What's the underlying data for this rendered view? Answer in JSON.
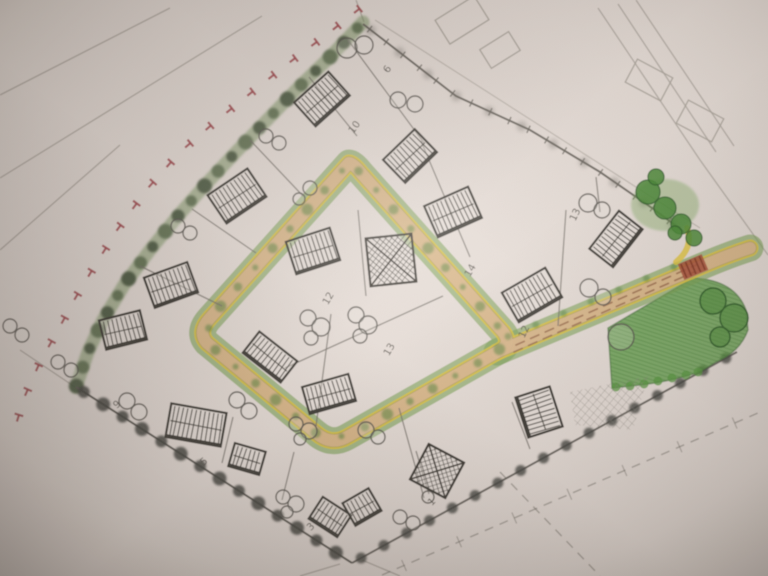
{
  "meta": {
    "type": "hand-drawn residential site plan sketch",
    "medium": "pencil and colored pencil on photographed paper",
    "description": "Diamond-shaped development site with a looped access road, hatched house footprints, tree symbols, hedgerows, a green open space with paved red crossing, and red T boundary markings."
  },
  "colors": {
    "paper": "#e7ded8",
    "pencil_dark": "#3d3a34",
    "pencil_mid": "#6f6b63",
    "pencil_faint": "#aba49b",
    "road_surface": "#dcb88d",
    "road_edge_yellow": "#e2c63e",
    "road_pencil_edge": "#8d867b",
    "verge_green": "#7ba155",
    "verge_blob_green": "#4e8038",
    "hedge_green": "#75905c",
    "hedge_dark": "#3e4c36",
    "open_space_green": "#55973d",
    "open_space_stroke": "#2f6b24",
    "tree_green_fill": "#4c8a38",
    "tree_green_stroke": "#30612a",
    "tree_outline": "#5b5852",
    "boundary_red": "#a34a50",
    "crossing_red": "#a8503a",
    "crossing_dark": "#7c3524",
    "centerline_brown": "#96684a",
    "number_ink": "#55514a"
  },
  "plan": {
    "loop_road_path": "M349,163 L210,318 Q197,332 207,343 L316,433 Q331,446 347,437 L499,351 Q512,344 503,332 L361,173 Q353,163 349,163 Z",
    "exit_road_path": "M497,352 L700,267 Q728,255 750,248",
    "exit_centerlines": [
      [
        516,
        345,
        696,
        265
      ],
      [
        514,
        352,
        694,
        272
      ]
    ],
    "exit_corner_curl": "M676,262 Q694,247 687,228",
    "crossing": {
      "x": 693,
      "y": 267,
      "w": 26,
      "h": 17,
      "r": -23
    },
    "hedge_points": [
      363,
      22,
      330,
      57,
      300,
      86,
      268,
      119,
      237,
      151,
      207,
      183,
      178,
      216,
      150,
      250,
      124,
      285,
      103,
      320,
      88,
      352,
      76,
      387
    ],
    "red_t_points": [
      368,
      2,
      330,
      32,
      290,
      62,
      252,
      92,
      215,
      122,
      180,
      152,
      148,
      188,
      120,
      226,
      97,
      262,
      76,
      297,
      58,
      330,
      40,
      362,
      24,
      398,
      12,
      438
    ],
    "sw_boundary": [
      76,
      387,
      352,
      563
    ],
    "se_boundary": [
      352,
      563,
      640,
      405,
      737,
      352
    ],
    "ne_boundary": [
      363,
      24,
      456,
      96,
      530,
      130,
      600,
      172,
      652,
      208,
      684,
      232
    ],
    "ne_parallel": [
      375,
      20,
      700,
      228
    ],
    "green_space_path": "M608,328 L693,278 Q735,280 746,310 L748,330 Q740,352 716,362 L700,372 Q668,382 640,385 L612,388 Z",
    "green_scallops": [
      [
        616,
        387
      ],
      [
        630,
        386
      ],
      [
        644,
        384
      ],
      [
        658,
        381
      ],
      [
        672,
        378
      ],
      [
        686,
        375
      ],
      [
        698,
        372
      ]
    ],
    "crosshatch_path": "M570,392 L648,376 L633,430 L575,425 Z",
    "buildings": [
      {
        "x": 322,
        "y": 99,
        "w": 46,
        "h": 32,
        "r": -42,
        "type": "h"
      },
      {
        "x": 237,
        "y": 196,
        "w": 48,
        "h": 34,
        "r": -34,
        "type": "h"
      },
      {
        "x": 171,
        "y": 285,
        "w": 46,
        "h": 32,
        "r": -20,
        "type": "h"
      },
      {
        "x": 123,
        "y": 330,
        "w": 42,
        "h": 30,
        "r": -14,
        "type": "h"
      },
      {
        "x": 196,
        "y": 425,
        "w": 56,
        "h": 34,
        "r": 10,
        "type": "h"
      },
      {
        "x": 247,
        "y": 459,
        "w": 32,
        "h": 24,
        "r": 16,
        "type": "h"
      },
      {
        "x": 330,
        "y": 517,
        "w": 34,
        "h": 26,
        "r": 33,
        "type": "h"
      },
      {
        "x": 362,
        "y": 507,
        "w": 30,
        "h": 26,
        "r": -30,
        "type": "h"
      },
      {
        "x": 437,
        "y": 471,
        "w": 40,
        "h": 40,
        "r": 28,
        "type": "x"
      },
      {
        "x": 313,
        "y": 251,
        "w": 46,
        "h": 34,
        "r": -18,
        "type": "h"
      },
      {
        "x": 391,
        "y": 260,
        "w": 46,
        "h": 48,
        "r": -6,
        "type": "x"
      },
      {
        "x": 270,
        "y": 357,
        "w": 48,
        "h": 27,
        "r": 38,
        "type": "h"
      },
      {
        "x": 329,
        "y": 394,
        "w": 48,
        "h": 28,
        "r": -16,
        "type": "h"
      },
      {
        "x": 410,
        "y": 156,
        "w": 44,
        "h": 32,
        "r": -44,
        "type": "h"
      },
      {
        "x": 453,
        "y": 212,
        "w": 48,
        "h": 34,
        "r": -24,
        "type": "h"
      },
      {
        "x": 532,
        "y": 295,
        "w": 50,
        "h": 34,
        "r": -30,
        "type": "h"
      },
      {
        "x": 616,
        "y": 239,
        "w": 48,
        "h": 30,
        "r": -52,
        "type": "h"
      },
      {
        "x": 539,
        "y": 412,
        "w": 36,
        "h": 42,
        "r": -18,
        "type": "h"
      }
    ],
    "faint_rects": [
      {
        "x": 462,
        "y": 20,
        "w": 46,
        "h": 28,
        "r": -32
      },
      {
        "x": 500,
        "y": 50,
        "w": 34,
        "h": 22,
        "r": -32
      },
      {
        "x": 649,
        "y": 80,
        "w": 40,
        "h": 26,
        "r": 28
      },
      {
        "x": 700,
        "y": 121,
        "w": 40,
        "h": 26,
        "r": 28
      }
    ],
    "trees_outline": [
      [
        347,
        48,
        10
      ],
      [
        364,
        45,
        9
      ],
      [
        398,
        100,
        8
      ],
      [
        415,
        104,
        8
      ],
      [
        588,
        203,
        9
      ],
      [
        602,
        210,
        8
      ],
      [
        589,
        288,
        9
      ],
      [
        603,
        297,
        8
      ],
      [
        621,
        337,
        13
      ],
      [
        127,
        401,
        8
      ],
      [
        139,
        412,
        8
      ],
      [
        237,
        400,
        8
      ],
      [
        249,
        411,
        8
      ],
      [
        10,
        326,
        7
      ],
      [
        22,
        335,
        7
      ],
      [
        58,
        362,
        7
      ],
      [
        71,
        370,
        7
      ],
      [
        178,
        226,
        7
      ],
      [
        190,
        233,
        7
      ],
      [
        266,
        136,
        7
      ],
      [
        279,
        143,
        7
      ],
      [
        310,
        188,
        7
      ],
      [
        299,
        199,
        6
      ],
      [
        308,
        318,
        8
      ],
      [
        321,
        327,
        9
      ],
      [
        311,
        338,
        7
      ],
      [
        356,
        315,
        8
      ],
      [
        368,
        325,
        9
      ],
      [
        360,
        336,
        7
      ],
      [
        296,
        424,
        7
      ],
      [
        309,
        431,
        8
      ],
      [
        300,
        439,
        6
      ],
      [
        366,
        430,
        8
      ],
      [
        378,
        437,
        7
      ],
      [
        283,
        497,
        7
      ],
      [
        296,
        504,
        8
      ],
      [
        287,
        512,
        6
      ],
      [
        400,
        517,
        7
      ],
      [
        413,
        523,
        7
      ],
      [
        428,
        497,
        6
      ]
    ],
    "trees_green": [
      [
        648,
        192,
        12
      ],
      [
        665,
        208,
        11
      ],
      [
        681,
        224,
        10
      ],
      [
        656,
        177,
        8
      ],
      [
        694,
        238,
        8
      ],
      [
        675,
        233,
        7
      ]
    ],
    "trees_large_green": [
      [
        713,
        301,
        13
      ],
      [
        734,
        318,
        14
      ],
      [
        720,
        337,
        10
      ]
    ],
    "plot_numbers": [
      {
        "t": "6",
        "x": 390,
        "y": 71,
        "r": -55
      },
      {
        "t": "10",
        "x": 357,
        "y": 129,
        "r": -55
      },
      {
        "t": "12",
        "x": 331,
        "y": 300,
        "r": -60
      },
      {
        "t": "13",
        "x": 392,
        "y": 351,
        "r": -60
      },
      {
        "t": "14",
        "x": 473,
        "y": 272,
        "r": -60
      },
      {
        "t": "13",
        "x": 578,
        "y": 216,
        "r": -65
      },
      {
        "t": "12",
        "x": 527,
        "y": 333,
        "r": -65
      },
      {
        "t": "9",
        "x": 119,
        "y": 407,
        "r": -40
      },
      {
        "t": "5",
        "x": 206,
        "y": 464,
        "r": -40
      },
      {
        "t": "3",
        "x": 313,
        "y": 529,
        "r": -45
      },
      {
        "t": "1",
        "x": 434,
        "y": 504,
        "r": -45
      }
    ],
    "plot_lines": [
      [
        309,
        77,
        357,
        136
      ],
      [
        250,
        140,
        303,
        196
      ],
      [
        192,
        209,
        256,
        253
      ],
      [
        140,
        266,
        222,
        306
      ],
      [
        348,
        40,
        424,
        143
      ],
      [
        421,
        141,
        470,
        257
      ],
      [
        566,
        210,
        558,
        326
      ],
      [
        596,
        177,
        600,
        212
      ],
      [
        358,
        210,
        366,
        296
      ],
      [
        285,
        368,
        443,
        296
      ],
      [
        331,
        314,
        316,
        426
      ],
      [
        233,
        417,
        222,
        463
      ],
      [
        294,
        452,
        282,
        500
      ],
      [
        399,
        408,
        424,
        498
      ],
      [
        512,
        402,
        530,
        449
      ],
      [
        416,
        451,
        429,
        494
      ]
    ],
    "faint_lines": [
      [
        0,
        95,
        170,
        8
      ],
      [
        0,
        178,
        262,
        16
      ],
      [
        0,
        250,
        120,
        145
      ],
      [
        598,
        8,
        700,
        160
      ],
      [
        618,
        4,
        716,
        152
      ],
      [
        636,
        0,
        734,
        146
      ],
      [
        700,
        160,
        768,
        255
      ],
      [
        364,
        22,
        356,
        0
      ],
      [
        75,
        387,
        20,
        350
      ],
      [
        340,
        564,
        300,
        576
      ],
      [
        362,
        560,
        400,
        576
      ]
    ],
    "dashed_faint": [
      [
        382,
        575,
        758,
        413
      ],
      [
        500,
        472,
        600,
        576
      ]
    ]
  }
}
